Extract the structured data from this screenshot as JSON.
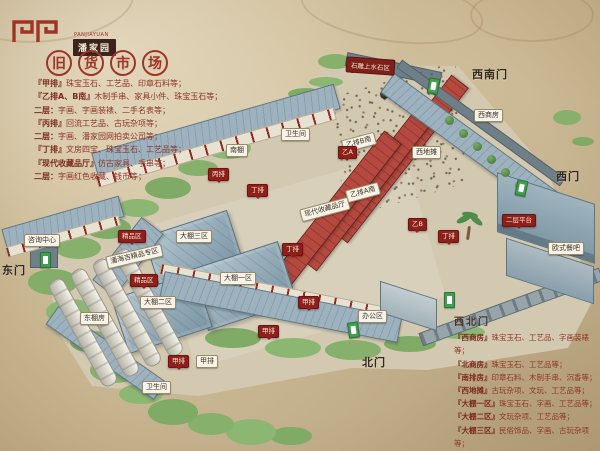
{
  "header": {
    "logo_text": "潘家园",
    "logo_sub": "PANJIAYUAN",
    "title_chars": [
      "旧",
      "货",
      "市",
      "场"
    ]
  },
  "legend_left": [
    {
      "name": "『甲排』",
      "desc": "珠宝玉石、工艺品、印章石料等；"
    },
    {
      "name": "『乙排A、B南』",
      "desc": "木制手串、家具小件、珠宝玉石等；"
    },
    {
      "name": "二层：",
      "desc": "字画、字画装裱、二手名表等；"
    },
    {
      "name": "『丙排』",
      "desc": "回流工艺品、古玩杂项等；"
    },
    {
      "name": "二层：",
      "desc": "字画、潘家园网拍卖公司等；"
    },
    {
      "name": "『丁排』",
      "desc": "文房四宝、珠宝玉石、工艺品等；"
    },
    {
      "name": "『现代收藏品厅』",
      "desc": "仿古家具、手串等；"
    },
    {
      "name": "二层：",
      "desc": "字画红色收藏、钱币等；"
    }
  ],
  "legend_right": {
    "header": "西北门",
    "lines": [
      {
        "name": "『西商房』",
        "desc": "珠宝玉石、工艺品、字画装裱等；"
      },
      {
        "name": "『北商房』",
        "desc": "珠宝玉石、工艺品等；"
      },
      {
        "name": "『南排房』",
        "desc": "印章石料、木制手串、沉香等；"
      },
      {
        "name": "『西地摊』",
        "desc": "古玩杂项、文玩、工艺品等；"
      },
      {
        "name": "『大棚一区』",
        "desc": "珠宝玉石、字画、工艺品等；"
      },
      {
        "name": "『大棚二区』",
        "desc": "文玩杂项、工艺品等；"
      },
      {
        "name": "『大棚三区』",
        "desc": "民俗饰品、字画、古玩杂项等；"
      },
      {
        "name": "『大棚四区』",
        "desc": "潘海吉精品专区"
      }
    ]
  },
  "map": {
    "area_sign": "石雕上水石区",
    "gates": [
      {
        "label": "东门"
      },
      {
        "label": "西南门"
      },
      {
        "label": "西门"
      },
      {
        "label": "北门"
      }
    ],
    "white_labels": [
      {
        "text": "卫生间"
      },
      {
        "text": "南棚"
      },
      {
        "text": "乙排B南"
      },
      {
        "text": "乙排A南"
      },
      {
        "text": "现代收藏品厅"
      },
      {
        "text": "西地摊"
      },
      {
        "text": "西商房"
      },
      {
        "text": "大棚三区"
      },
      {
        "text": "大棚一区"
      },
      {
        "text": "大棚二区"
      },
      {
        "text": "潘海吉精品专区"
      },
      {
        "text": "东棚房"
      },
      {
        "text": "卫生间"
      },
      {
        "text": "欧式餐吧"
      },
      {
        "text": "办公区"
      },
      {
        "text": "咨询中心"
      },
      {
        "text": "甲排"
      }
    ],
    "red_badges": [
      {
        "text": "精品区"
      },
      {
        "text": "精品区"
      },
      {
        "text": "乙A"
      },
      {
        "text": "乙B"
      },
      {
        "text": "丙排"
      },
      {
        "text": "丁排"
      },
      {
        "text": "丁排"
      },
      {
        "text": "甲排"
      },
      {
        "text": "甲排"
      },
      {
        "text": "甲排"
      },
      {
        "text": "二层平台"
      },
      {
        "text": "丁排"
      }
    ],
    "colors": {
      "seal_red": "#9e2d22",
      "badge_red": "#8f1f1a",
      "roof_blue": "#93aab7",
      "roof_red": "#b3493f",
      "foliage_green": "#86b06c",
      "gate_sign_green": "#3f9e4f",
      "parchment": "#cfc0a2"
    }
  }
}
